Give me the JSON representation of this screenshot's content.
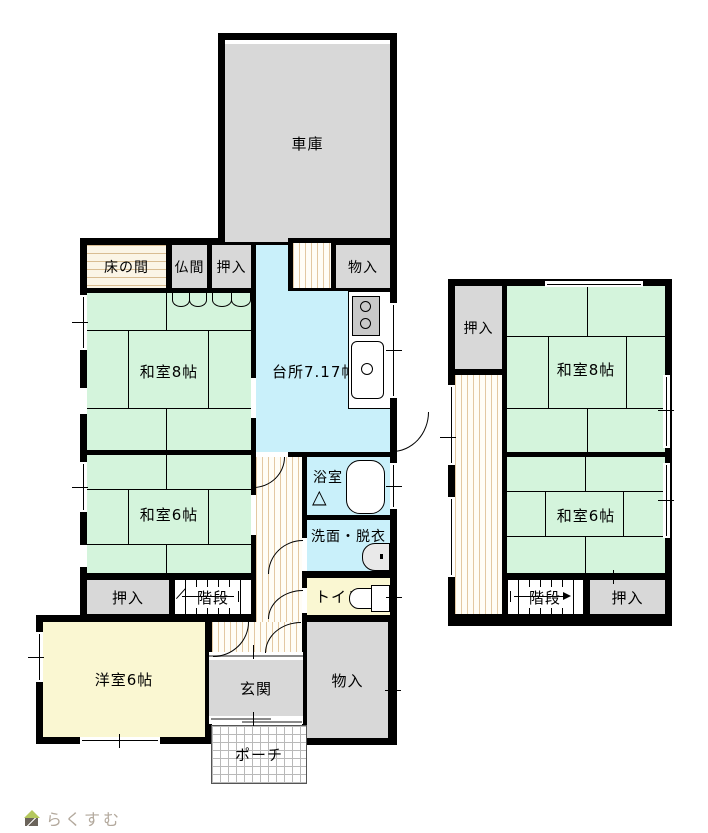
{
  "floor1": {
    "garage": {
      "label": "車庫"
    },
    "tokonoma": {
      "label": "床の間"
    },
    "butsuma": {
      "label": "仏間"
    },
    "oshiire_top": {
      "label": "押入"
    },
    "monoire_top": {
      "label": "物入"
    },
    "washitsu8": {
      "label": "和室8帖"
    },
    "kitchen": {
      "label": "台所7.17帖"
    },
    "washitsu6": {
      "label": "和室6帖"
    },
    "bath": {
      "label": "浴室"
    },
    "senmen": {
      "label": "洗面・脱衣"
    },
    "oshiire_mid": {
      "label": "押入"
    },
    "kaidan": {
      "label": "階段"
    },
    "toilet": {
      "label": "トイレ"
    },
    "yoshitsu": {
      "label": "洋室6帖"
    },
    "genkan": {
      "label": "玄関"
    },
    "monoire_bottom": {
      "label": "物入"
    },
    "porch": {
      "label": "ポーチ"
    }
  },
  "floor2": {
    "oshiire_top": {
      "label": "押入"
    },
    "washitsu8": {
      "label": "和室8帖"
    },
    "washitsu6": {
      "label": "和室6帖"
    },
    "kaidan": {
      "label": "階段"
    },
    "oshiire_bottom": {
      "label": "押入"
    }
  },
  "icons": {
    "folding_door": "△"
  },
  "logo": {
    "text": "らくすむ"
  },
  "colors": {
    "wall": "#000000",
    "tatami_green": "#d4f4dc",
    "water_cyan": "#c9f0fa",
    "closet_gray": "#d8d8d8",
    "western_yellow": "#faf7d2",
    "hatch_tan": "#e3c8a2",
    "logo_text": "#b3a99d",
    "logo_roof_green": "#b5c85e"
  }
}
